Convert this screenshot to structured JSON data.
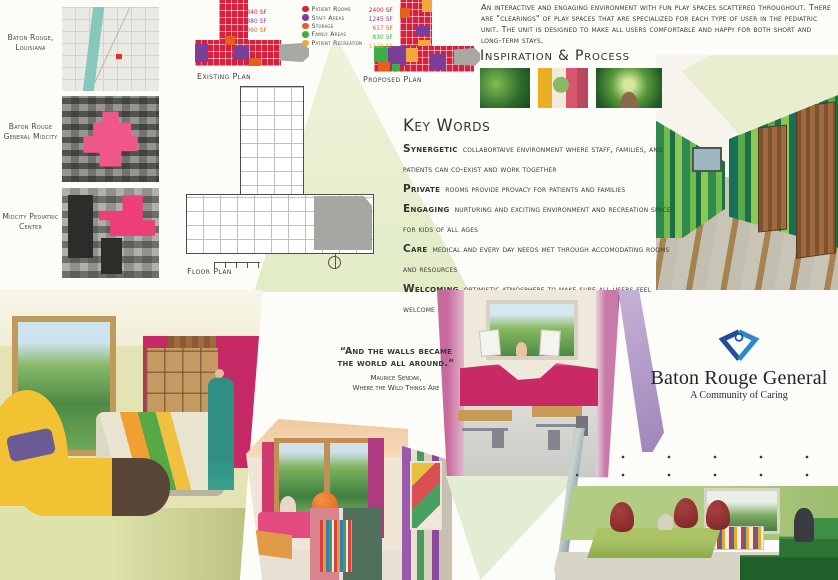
{
  "poster": {
    "background": "#fcfcf8",
    "accent_green": "#e3ecca",
    "location_column": {
      "highlight_color": "#ee4d7e",
      "items": [
        {
          "label": "Baton Rouge, Louisiana",
          "image": "street-map-thumbnail"
        },
        {
          "label": "Baton Rouge General Midcity",
          "image": "aerial-photo-hospital-highlighted"
        },
        {
          "label": "Midcity Pediatric Center",
          "image": "aerial-photo-pediatric-center-highlighted"
        }
      ]
    },
    "plans": {
      "existing": {
        "label": "Existing Plan",
        "areas": [
          {
            "value": "3840 SF",
            "category": "Patient Rooms",
            "color": "#d6203e"
          },
          {
            "value": "880 SF",
            "category": "Staff Areas",
            "color": "#7b3f98"
          },
          {
            "value": "360 SF",
            "category": "Storage",
            "color": "#e55f1e"
          }
        ]
      },
      "proposed": {
        "label": "Proposed Plan",
        "areas": [
          {
            "value": "2400 SF",
            "category": "Patient Rooms",
            "color": "#d6203e"
          },
          {
            "value": "1245 SF",
            "category": "Staff Areas",
            "color": "#7b3f98"
          },
          {
            "value": "617 SF",
            "category": "Storage",
            "color": "#e55f1e"
          },
          {
            "value": "830 SF",
            "category": "Family Areas",
            "color": "#3fae49"
          },
          {
            "value": "1128 SF",
            "category": "Patient Recreation",
            "color": "#f2a93c"
          }
        ]
      },
      "floor": {
        "label": "Floor Plan"
      },
      "legend": [
        {
          "label": "Patient Rooms",
          "color": "#d6203e"
        },
        {
          "label": "Staff Areas",
          "color": "#7b3f98"
        },
        {
          "label": "Storage",
          "color": "#e55f1e"
        },
        {
          "label": "Family Areas",
          "color": "#3fae49"
        },
        {
          "label": "Patient Recreation",
          "color": "#f2a93c"
        }
      ]
    },
    "intro_paragraph": "An interactive and engaging environment with fun play spaces scattered throughout.  There are \"clearings\" of play spaces that are specialized for each type of user in the pediatric unit.  The unit is designed to make all users comfortable and happy for both short and long-term stays.",
    "inspiration": {
      "heading": "Inspiration & Process",
      "images": [
        "jungle-foliage-photo",
        "colorful-room-sketch",
        "forest-path-photo"
      ]
    },
    "key_words": {
      "heading": "Key Words",
      "terms": [
        {
          "term": "Synergetic",
          "definition": "collabortaive environment where staff, families, and patients can co-exist and work together"
        },
        {
          "term": "Private",
          "definition": "rooms provide provacy for patients and families"
        },
        {
          "term": "Engaging",
          "definition": "nurturing and exciting environment and recreation space for kids of all ages"
        },
        {
          "term": "Care",
          "definition": "medical and every day needs met through accomodating rooms and resources"
        },
        {
          "term": "Welcoming",
          "definition": "optimistic atmosphere to make sure all users feel welcome and at ease"
        }
      ]
    },
    "quote": {
      "line1": "“And the walls became",
      "line2": "the world all around.”",
      "attribution1": "Maurice Sendak,",
      "attribution2": "Where the Wild Things Are"
    },
    "renderings": {
      "patient_room": "patient-room-rendering",
      "reading_nook": "reading-nook-rendering",
      "playroom": "playroom-rendering",
      "poster_nook": "poster-nook-rendering",
      "teen_lounge": "teen-lounge-rendering",
      "corridor_sketch": "tree-corridor-sketch"
    },
    "logo": {
      "name": "Baton Rouge General",
      "tagline": "A Community of Caring",
      "heart_dark": "#1e4e9c",
      "heart_light": "#2a8ac6"
    }
  }
}
